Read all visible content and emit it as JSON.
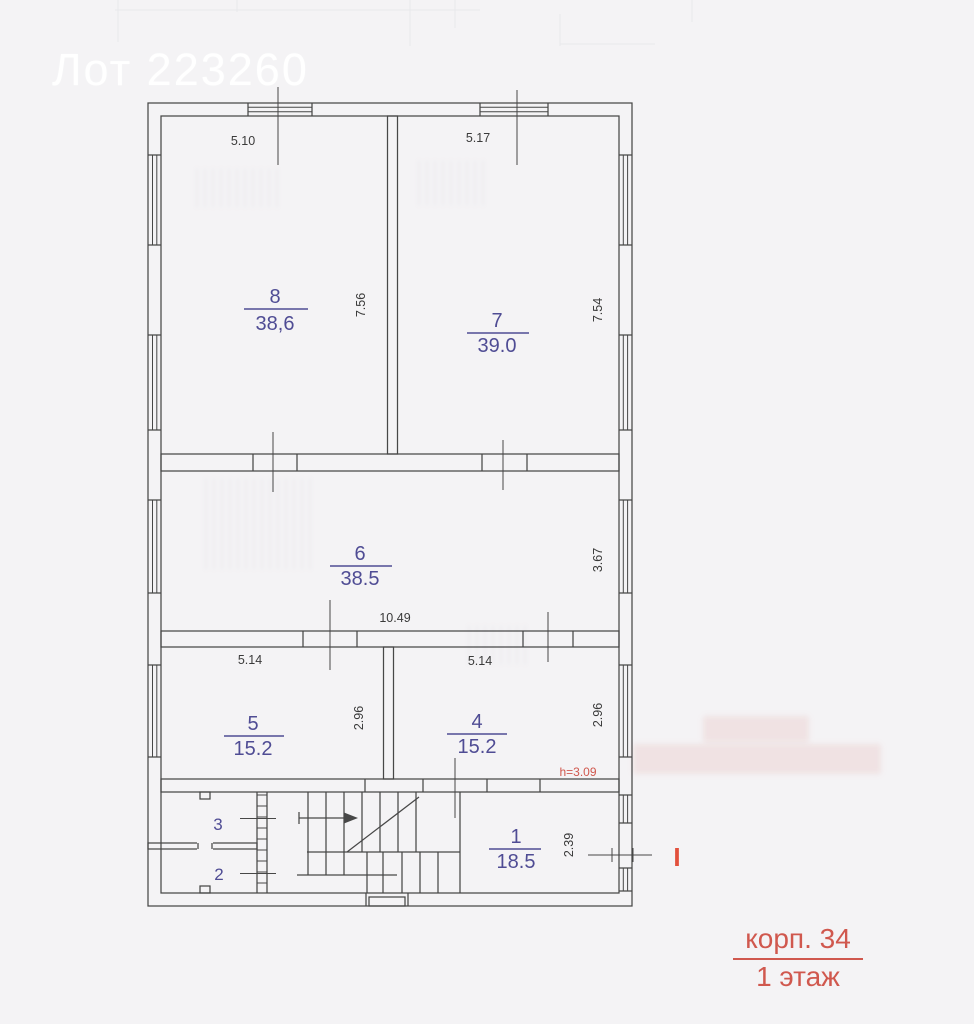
{
  "colors": {
    "bg": "#f4f3f5",
    "line": "#474747",
    "dim-text": "#3a3a3a",
    "room-label": "#4f4c94",
    "red-note": "#d0584e",
    "red-mark": "#e2503c",
    "watermark": "#ffffff"
  },
  "watermark": {
    "lot_label": "Лот 223260"
  },
  "plan": {
    "rooms": [
      {
        "number": "8",
        "area": "38,6"
      },
      {
        "number": "7",
        "area": "39.0"
      },
      {
        "number": "6",
        "area": "38.5"
      },
      {
        "number": "5",
        "area": "15.2"
      },
      {
        "number": "4",
        "area": "15.2"
      },
      {
        "number": "1",
        "area": "18.5"
      },
      {
        "number": "3"
      },
      {
        "number": "2"
      }
    ],
    "dimensions": {
      "top_left": "5.10",
      "top_right": "5.17",
      "left_upper": "7.56",
      "right_upper": "7.54",
      "right_mid": "3.67",
      "mid_width": "10.49",
      "mid_left": "5.14",
      "mid_right": "5.14",
      "lower_left": "2.96",
      "lower_right": "2.96",
      "room1_depth": "2.39"
    },
    "notes": {
      "ceiling_height": "h=3.09",
      "section_mark": "I"
    }
  },
  "title_block": {
    "building": "корп. 34",
    "floor": "1 этаж"
  }
}
